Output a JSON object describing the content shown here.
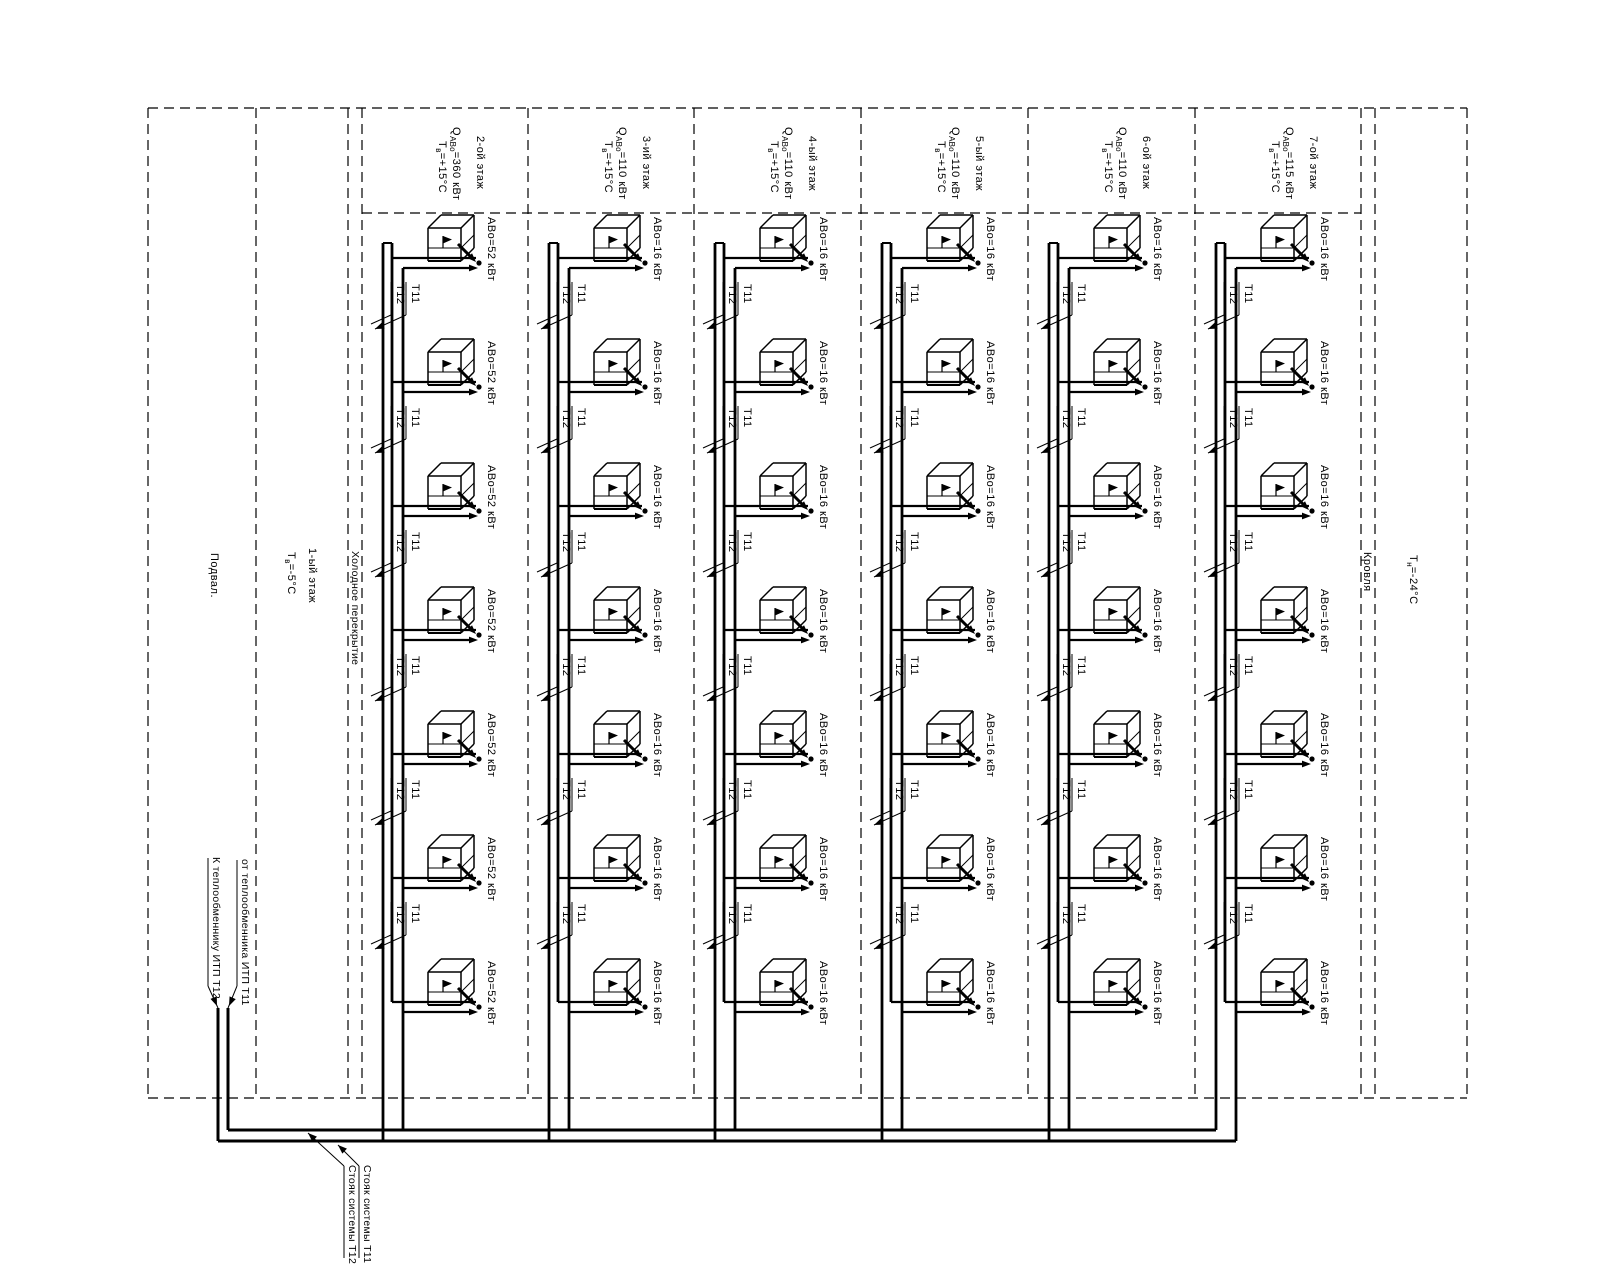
{
  "drawing": {
    "left_zone": {
      "basement": "Подвал.",
      "floor1": "1-ый этаж",
      "floor1_temp": {
        "main": "Т",
        "sub": "в",
        "rest": "=-5°С"
      },
      "cold_slab": "Холодное перекрытие"
    },
    "right_zone": {
      "roof": "Кровля",
      "outdoor_temp": {
        "main": "Т",
        "sub": "н",
        "rest": "=-24°С"
      }
    },
    "floors": [
      {
        "name": "2-ой этаж",
        "q": {
          "main": "Q",
          "sub": "АВо",
          "rest": "=360 кВт"
        },
        "temp": {
          "main": "Т",
          "sub": "в",
          "rest": "=+15°С"
        },
        "unit_label": "АВо=52 кВт",
        "unit_count": 7
      },
      {
        "name": "3-ий этаж",
        "q": {
          "main": "Q",
          "sub": "АВо",
          "rest": "=110 кВт"
        },
        "temp": {
          "main": "Т",
          "sub": "в",
          "rest": "=+15°С"
        },
        "unit_label": "АВо=16 кВт",
        "unit_count": 7
      },
      {
        "name": "4-ый этаж",
        "q": {
          "main": "Q",
          "sub": "АВо",
          "rest": "=110 кВт"
        },
        "temp": {
          "main": "Т",
          "sub": "в",
          "rest": "=+15°С"
        },
        "unit_label": "АВо=16 кВт",
        "unit_count": 7
      },
      {
        "name": "5-ый этаж",
        "q": {
          "main": "Q",
          "sub": "АВо",
          "rest": "=110 кВт"
        },
        "temp": {
          "main": "Т",
          "sub": "в",
          "rest": "=+15°С"
        },
        "unit_label": "АВо=16 кВт",
        "unit_count": 7
      },
      {
        "name": "6-ой этаж",
        "q": {
          "main": "Q",
          "sub": "АВо",
          "rest": "=110 кВт"
        },
        "temp": {
          "main": "Т",
          "sub": "в",
          "rest": "=+15°С"
        },
        "unit_label": "АВо=16 кВт",
        "unit_count": 7
      },
      {
        "name": "7-ой этаж",
        "q": {
          "main": "Q",
          "sub": "АВо",
          "rest": "=115 кВт"
        },
        "temp": {
          "main": "Т",
          "sub": "в",
          "rest": "=+15°С"
        },
        "unit_label": "АВо=16 кВт",
        "unit_count": 7
      }
    ],
    "riser_tags": {
      "supply": "Т11",
      "return": "Т12"
    },
    "bottom_zone": {
      "to_hx": "К теплообменнику ИТП Т12",
      "from_hx": "от теплообменника ИТП Т11",
      "riser_t11": "Стояк системы Т11",
      "riser_t12": "Стояк системы Т12"
    },
    "colors": {
      "ink": "#000000",
      "paper": "#ffffff"
    }
  }
}
